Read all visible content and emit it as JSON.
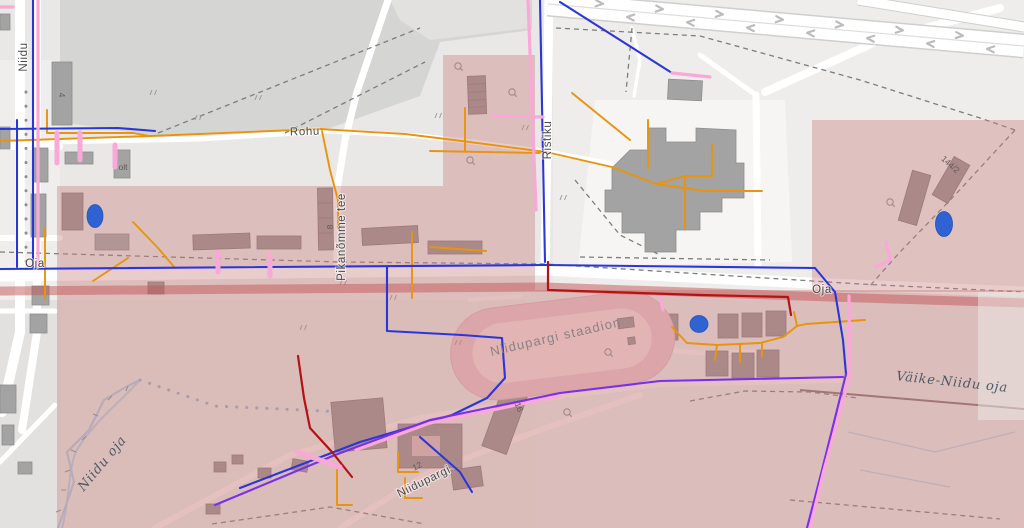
{
  "map": {
    "labels": {
      "niidu": "Niidu",
      "rohu": "Rohu",
      "ristiku": "Ristiku",
      "pikanomme_tee": "Pikanõmme tee",
      "oja_west": "Oja",
      "oja_east": "Oja",
      "niidupargi_street": "Niidupargi",
      "stadium": "Niidupargi staadion",
      "vaike_niidu_oja": "Väike-Niidu oja",
      "niidu_oja": "Niidu oja",
      "bnum_4": "4",
      "bnum_8": "8",
      "bnum_olt": "olt",
      "bnum_144_2": "144/2",
      "bnum_16": "16",
      "bnum_12": "12"
    },
    "markers": [
      {
        "id": "marker-west",
        "x": 95,
        "y": 216
      },
      {
        "id": "marker-cluster",
        "x": 699,
        "y": 324
      },
      {
        "id": "marker-east",
        "x": 944,
        "y": 224
      }
    ],
    "colors": {
      "line_blue": "#2b36d9",
      "line_purple": "#7a2fe8",
      "line_orange": "#e8940c",
      "line_red": "#b51313",
      "line_pink": "#f9a8d7",
      "marker_blue": "#2f63d4",
      "overlay_pink": "#c97f7f",
      "overlay_stripe_red": "#c25555"
    }
  }
}
